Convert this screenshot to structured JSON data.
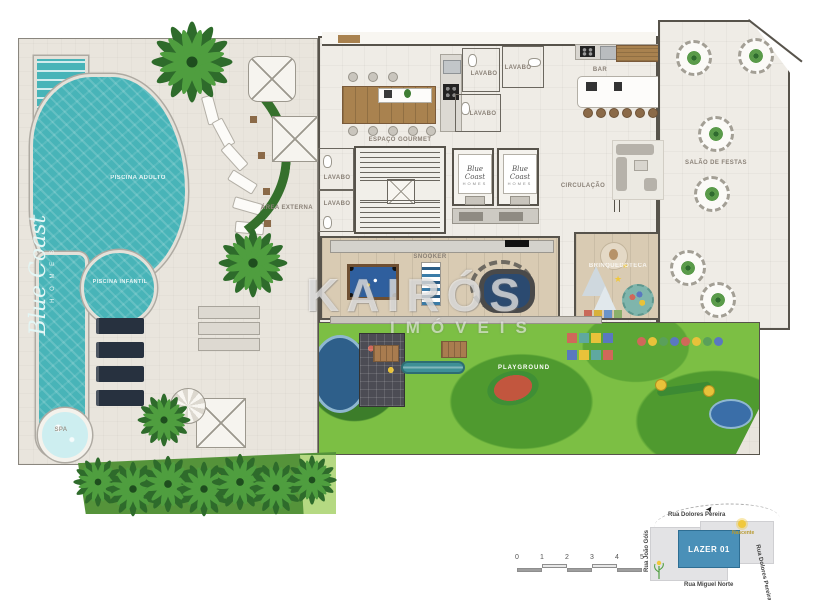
{
  "watermark": {
    "title": "KAIRÓS",
    "subtitle": "IMÓVEIS"
  },
  "branding": {
    "pool_script": "Blue Coast",
    "pool_sub": "H O M E S",
    "elevator_logo": "Blue Coast",
    "elevator_sub": "HOMES"
  },
  "labels": {
    "gourmet": "ESPAÇO GOURMET",
    "bar": "BAR",
    "party_hall": "SALÃO DE FESTAS",
    "circulation": "CIRCULAÇÃO",
    "outdoor_area": "ÁREA EXTERNA",
    "lavabo": "LAVABO",
    "games": "SNOOKER",
    "kids_room": "BRINQUEDOTECA",
    "playground": "PLAYGROUND",
    "pool_adult": "PISCINA ADULTO",
    "pool_kids": "PISCINA INFANTIL",
    "spa": "SPA"
  },
  "minimap": {
    "unit_label": "LAZER 01",
    "street_top": "Rua Dolores Pereira",
    "street_right": "Rua Dolores Pereira",
    "street_bottom": "Rua Miguel Norte",
    "street_left": "Rua João Góis",
    "sun_label": "Nascente"
  },
  "scale_bar": {
    "ticks": [
      "0",
      "1",
      "2",
      "3",
      "4",
      "5"
    ]
  },
  "colors": {
    "water": "#48b4b8",
    "grass": "#7cbf44",
    "plan_blue": "#4a90b8",
    "wood": "#a9824f"
  }
}
